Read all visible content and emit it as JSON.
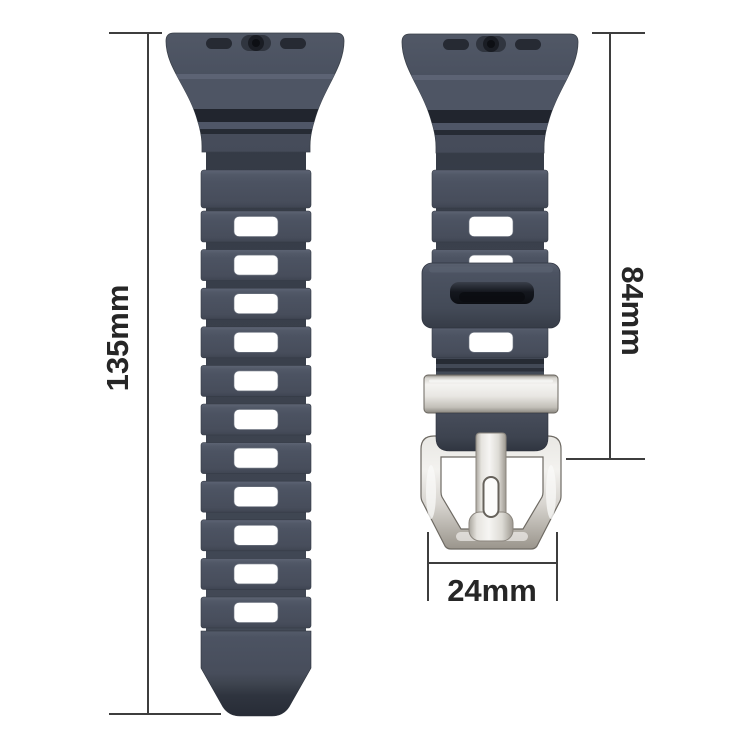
{
  "diagram": {
    "subject": "watch-band-with-buckle",
    "dimensions": {
      "long_strap": {
        "label": "135mm",
        "value": 135,
        "unit": "mm"
      },
      "short_strap": {
        "label": "84mm",
        "value": 84,
        "unit": "mm"
      },
      "band_width": {
        "label": "24mm",
        "value": 24,
        "unit": "mm"
      }
    },
    "colors": {
      "strap": "#4a5160",
      "strap_recess": "#363c47",
      "strap_groove": "#21252e",
      "hole": "#ffffff",
      "metal_light": "#f2f1ee",
      "metal_mid": "#c9c6bf",
      "metal_dark": "#9a958c",
      "dimension_line": "#3e3e3e",
      "label_text": "#262626",
      "background": "#ffffff"
    }
  }
}
